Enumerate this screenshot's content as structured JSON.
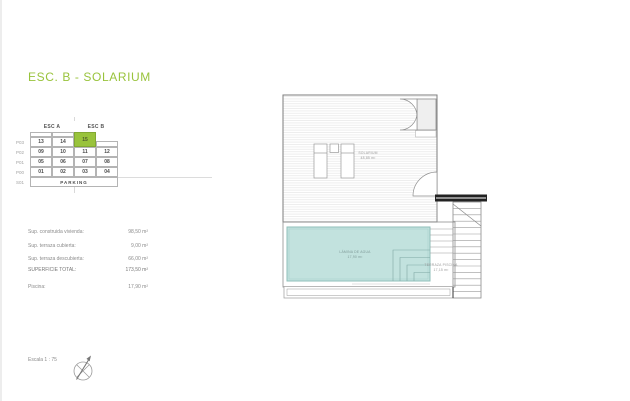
{
  "page": {
    "title": "ESC. B - SOLARIUM",
    "scale_label": "Escala 1 : 75"
  },
  "colors": {
    "accent_green": "#99C33C",
    "accent_green_border": "#82A833",
    "table_border": "#b4b4b4",
    "muted_text": "#8b8b8b",
    "plan_line": "#8f8f8f",
    "pool_fill": "#C2E2DE",
    "pool_border": "#8FBFBA",
    "beam_black": "#222222"
  },
  "table": {
    "col_groups": [
      "ESC A",
      "ESC B"
    ],
    "highlighted_unit": "15",
    "rows": [
      {
        "label": "P03",
        "cells": [
          "13",
          "14",
          "15"
        ]
      },
      {
        "label": "P02",
        "cells": [
          "09",
          "10",
          "11",
          "12"
        ]
      },
      {
        "label": "P01",
        "cells": [
          "05",
          "06",
          "07",
          "08"
        ]
      },
      {
        "label": "P00",
        "cells": [
          "01",
          "02",
          "03",
          "04"
        ]
      },
      {
        "label": "S01",
        "cells": [
          "PARKING"
        ]
      }
    ]
  },
  "summary": {
    "items": [
      {
        "label": "Sup. construida vivienda:",
        "value": "98,50 m²"
      },
      {
        "label": "Sup. terraza cubierta:",
        "value": "9,00 m²"
      },
      {
        "label": "Sup. terraza descubierta:",
        "value": "66,00 m²"
      },
      {
        "label": "SUPERFICIE TOTAL:",
        "value": "173,50 m²"
      },
      {
        "label": "Piscina:",
        "value": "17,90 m²"
      }
    ]
  },
  "plan": {
    "solarium_name": "SOLARIUM",
    "solarium_area": "48,85 m²",
    "pool_name": "LÁMINA DE AGUA",
    "pool_area": "17,90 m²",
    "terrace_name": "TERRAZA PISCINA",
    "terrace_area": "17,15 m²"
  }
}
